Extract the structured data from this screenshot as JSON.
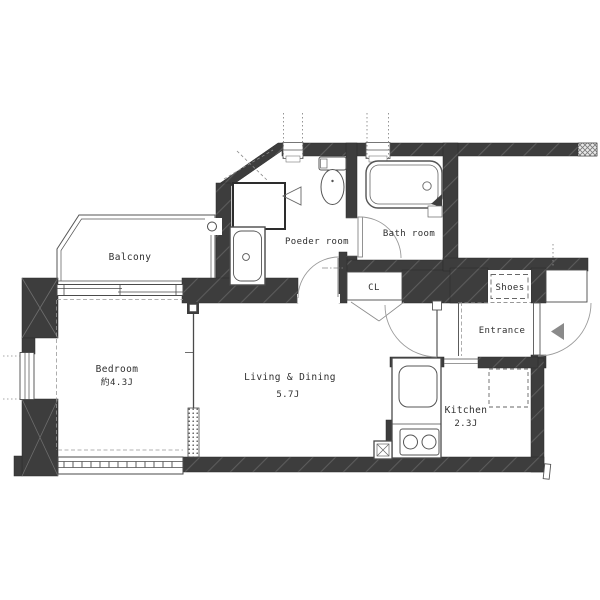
{
  "floor_plan": {
    "type": "apartment-floor-plan",
    "rooms": [
      {
        "id": "balcony",
        "label": "Balcony"
      },
      {
        "id": "bedroom",
        "label": "Bedroom",
        "size_label": "約4.3J"
      },
      {
        "id": "living_dining",
        "label": "Living & Dining",
        "size_label": "5.7J"
      },
      {
        "id": "kitchen",
        "label": "Kitchen",
        "size_label": "2.3J"
      },
      {
        "id": "powder_room",
        "label": "Poeder room"
      },
      {
        "id": "bath_room",
        "label": "Bath room"
      },
      {
        "id": "closet",
        "label": "CL"
      },
      {
        "id": "shoes",
        "label": "Shoes"
      },
      {
        "id": "entrance",
        "label": "Entrance"
      }
    ],
    "fixtures": [
      "bathtub",
      "toilet",
      "washbasin",
      "laundry-space",
      "kitchen-sink",
      "stove-2-burner",
      "refrigerator-space",
      "shoes-cabinet",
      "front-door",
      "duct"
    ],
    "colors": {
      "wall": "#3d3d3d",
      "wall_hatch": "#5c5c5c",
      "floor": "#ffffff",
      "line": "#4a4a4a",
      "light_line": "#8a8a8a",
      "door_arc": "#9a9a9a",
      "text": "#2f2f2f"
    }
  }
}
